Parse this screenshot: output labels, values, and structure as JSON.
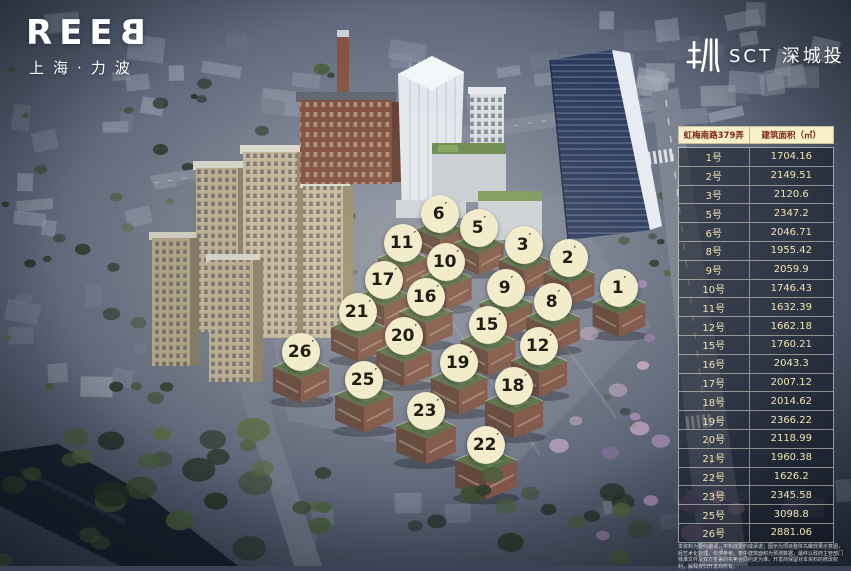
{
  "branding": {
    "reeb_word": "REEB",
    "reeb_subtitle": "上海·力波",
    "sct_label": "SCT 深城投"
  },
  "table": {
    "header_address": "虹梅南路379弄",
    "header_area": "建筑面积（㎡）",
    "rows": [
      {
        "no": "1号",
        "area": "1704.16"
      },
      {
        "no": "2号",
        "area": "2149.51"
      },
      {
        "no": "3号",
        "area": "2120.6"
      },
      {
        "no": "5号",
        "area": "2347.2"
      },
      {
        "no": "6号",
        "area": "2046.71"
      },
      {
        "no": "8号",
        "area": "1955.42"
      },
      {
        "no": "9号",
        "area": "2059.9"
      },
      {
        "no": "10号",
        "area": "1746.43"
      },
      {
        "no": "11号",
        "area": "1632.39"
      },
      {
        "no": "12号",
        "area": "1662.18"
      },
      {
        "no": "15号",
        "area": "1760.21"
      },
      {
        "no": "16号",
        "area": "2043.3"
      },
      {
        "no": "17号",
        "area": "2007.12"
      },
      {
        "no": "18号",
        "area": "2014.62"
      },
      {
        "no": "19号",
        "area": "2366.22"
      },
      {
        "no": "20号",
        "area": "2118.99"
      },
      {
        "no": "21号",
        "area": "1960.38"
      },
      {
        "no": "22号",
        "area": "1626.2"
      },
      {
        "no": "23号",
        "area": "2345.58"
      },
      {
        "no": "25号",
        "area": "3098.8"
      },
      {
        "no": "26号",
        "area": "2881.06"
      }
    ]
  },
  "markers": [
    {
      "num": "1",
      "prime": "′",
      "x": 619,
      "y": 288
    },
    {
      "num": "2",
      "prime": "′",
      "x": 569,
      "y": 258
    },
    {
      "num": "3",
      "prime": "′",
      "x": 524,
      "y": 245
    },
    {
      "num": "5",
      "prime": "′",
      "x": 479,
      "y": 228
    },
    {
      "num": "6",
      "prime": "′",
      "x": 440,
      "y": 214
    },
    {
      "num": "8",
      "prime": "′",
      "x": 553,
      "y": 302
    },
    {
      "num": "9",
      "prime": "′",
      "x": 506,
      "y": 288
    },
    {
      "num": "10",
      "prime": "′",
      "x": 446,
      "y": 262
    },
    {
      "num": "11",
      "prime": "′",
      "x": 403,
      "y": 243
    },
    {
      "num": "12",
      "prime": "′",
      "x": 539,
      "y": 346
    },
    {
      "num": "15",
      "prime": "′",
      "x": 488,
      "y": 325
    },
    {
      "num": "16",
      "prime": "′",
      "x": 426,
      "y": 297
    },
    {
      "num": "17",
      "prime": "′",
      "x": 384,
      "y": 280
    },
    {
      "num": "18",
      "prime": "′",
      "x": 514,
      "y": 386
    },
    {
      "num": "19",
      "prime": "′",
      "x": 459,
      "y": 363
    },
    {
      "num": "20",
      "prime": "′",
      "x": 404,
      "y": 336
    },
    {
      "num": "21",
      "prime": "′",
      "x": 358,
      "y": 312
    },
    {
      "num": "22",
      "prime": "′",
      "x": 486,
      "y": 445
    },
    {
      "num": "23",
      "prime": "′",
      "x": 426,
      "y": 411
    },
    {
      "num": "25",
      "prime": "′",
      "x": 364,
      "y": 380
    },
    {
      "num": "26",
      "prime": "′",
      "x": 301,
      "y": 352
    }
  ],
  "disclaimer": "本资料为要约邀请，不构成要约或承诺；图示为项目整体鸟瞰效果示意图，经艺术化处理，仅供参考。表中建筑面积为预测数据，最终以政府主管部门核准文件及双方签署的买卖合同约定为准。开发商保留对本资料的修改权利，解释权归开发商所有。",
  "colors": {
    "marker_bg": "#f2ecca",
    "marker_text": "#221c12",
    "table_header_bg": "#f7f0cb",
    "table_header_text": "#7c2318",
    "table_row_bg": "rgba(12,16,26,0.52)",
    "table_row_text": "#efe5b2"
  }
}
